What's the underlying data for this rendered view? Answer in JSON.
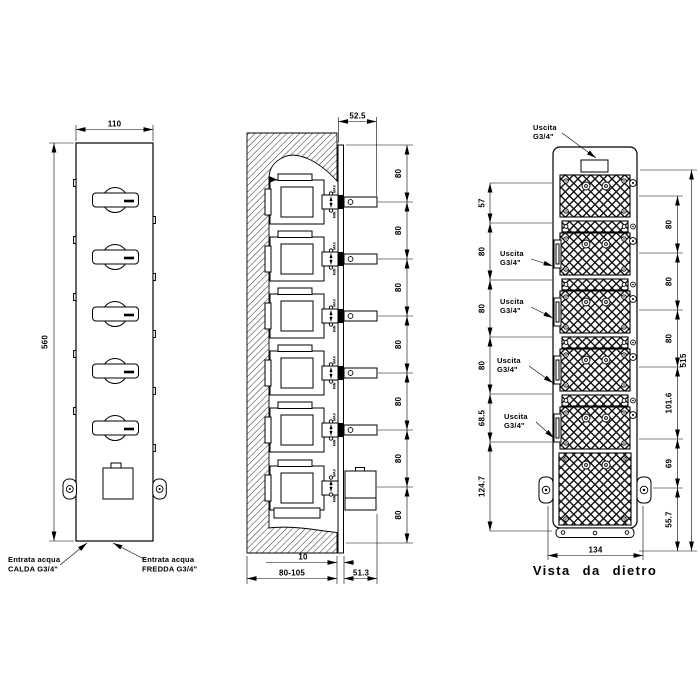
{
  "front_view": {
    "dim_width": "110",
    "dim_height": "560",
    "inlet_hot_line1": "Entrata acqua",
    "inlet_hot_line2": "CALDA G3/4\"",
    "inlet_cold_line1": "Entrata acqua",
    "inlet_cold_line2": "FREDDA G3/4\""
  },
  "section_view": {
    "dim_handle_depth": "52.5",
    "dim_plate_offset": "10",
    "dim_wall_depth": "80-105",
    "dim_trim_depth": "51.3",
    "spacing_dims": [
      "80",
      "80",
      "80",
      "80",
      "80",
      "80",
      "80"
    ],
    "max_label": "MAX",
    "min_label": "MIN"
  },
  "back_view": {
    "title": "Vista da dietro",
    "dim_overall_height": "515",
    "dim_width": "134",
    "left_dims": [
      "57",
      "80",
      "80",
      "80",
      "68.5",
      "124.7"
    ],
    "right_dims": [
      "80",
      "80",
      "80",
      "101.6",
      "69",
      "55.7"
    ],
    "outlets": [
      {
        "line1": "Uscita",
        "line2": "G3/4\""
      },
      {
        "line1": "Uscita",
        "line2": "G3/4\""
      },
      {
        "line1": "Uscita",
        "line2": "G3/4\""
      },
      {
        "line1": "Uscita",
        "line2": "G3/4\""
      },
      {
        "line1": "Uscita",
        "line2": "G3/4\""
      }
    ]
  }
}
